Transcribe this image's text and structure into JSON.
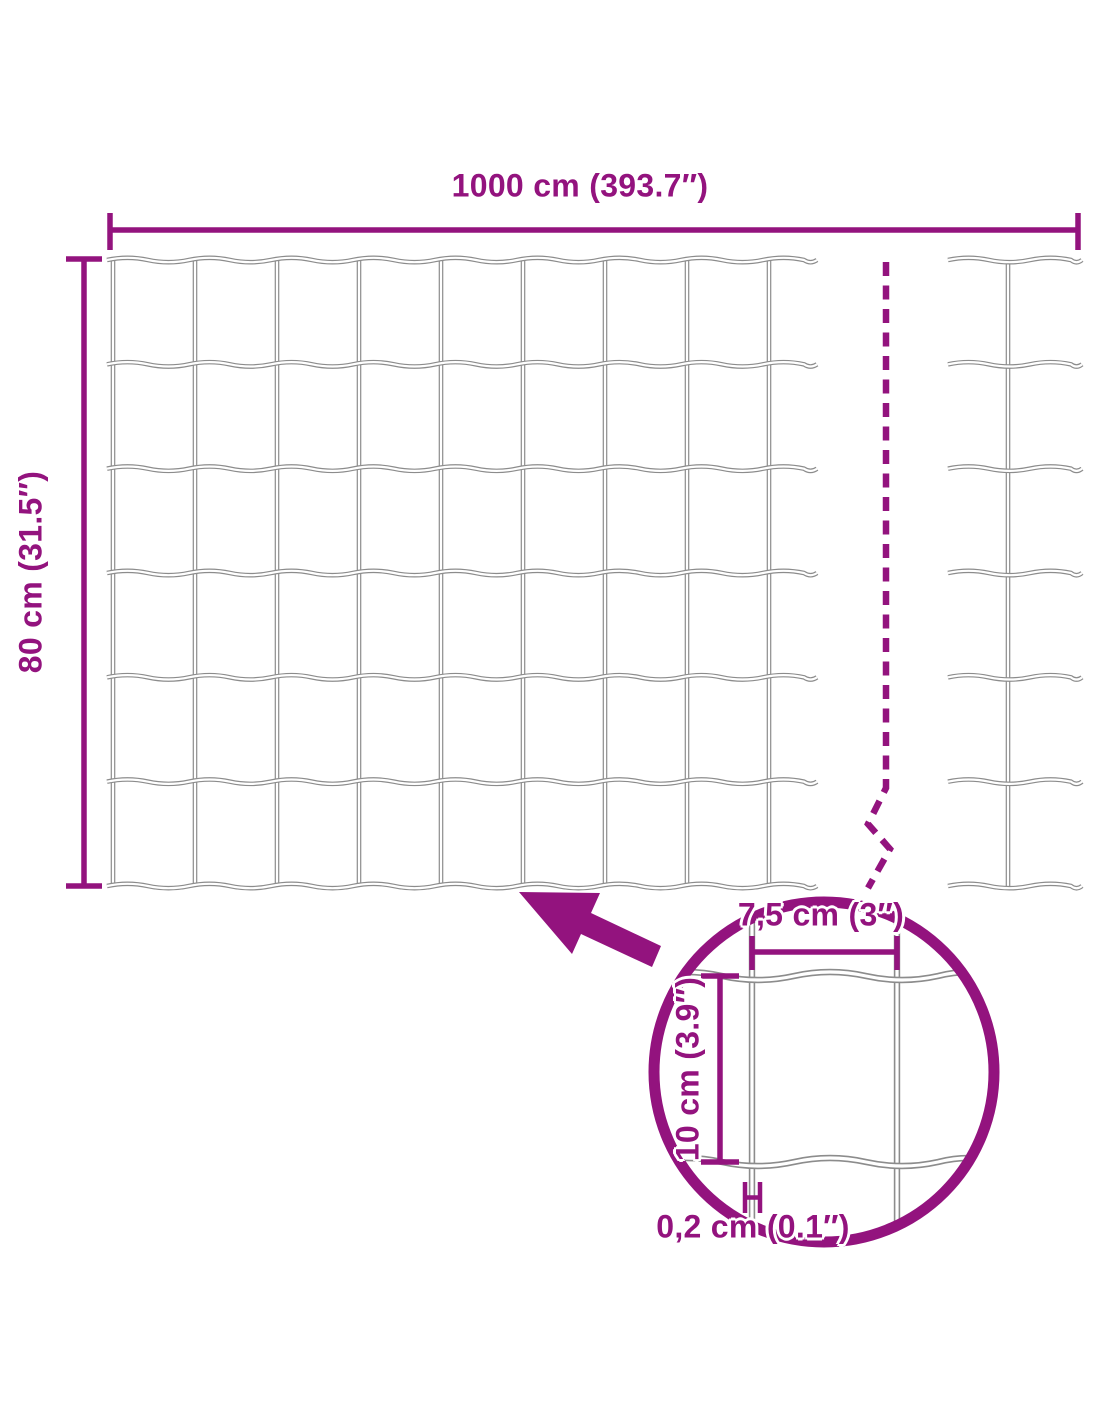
{
  "colors": {
    "accent": "#93137E",
    "wire": "#8C8C8C",
    "wire_core": "#FFFFFF",
    "background": "#FFFFFF"
  },
  "dimensions": {
    "total_width": {
      "label": "1000 cm (393.7″)",
      "cm": 1000,
      "inches": 393.7
    },
    "total_height": {
      "label": "80 cm (31.5″)",
      "cm": 80,
      "inches": 31.5
    },
    "mesh_cell_width": {
      "label": "7,5 cm (3″)",
      "cm": 7.5,
      "inches": 3
    },
    "mesh_cell_height": {
      "label": "10 cm (3.9″)",
      "cm": 10,
      "inches": 3.9
    },
    "wire_thickness": {
      "label": "0,2 cm (0.1″)",
      "cm": 0.2,
      "inches": 0.1
    }
  },
  "mesh": {
    "main_section": {
      "vertical_wires": 9,
      "horizontal_wires": 7
    },
    "right_section": {
      "vertical_wires": 1,
      "horizontal_wires": 7
    },
    "detail_section": {
      "vertical_wires": 2,
      "horizontal_wires": 2
    }
  }
}
